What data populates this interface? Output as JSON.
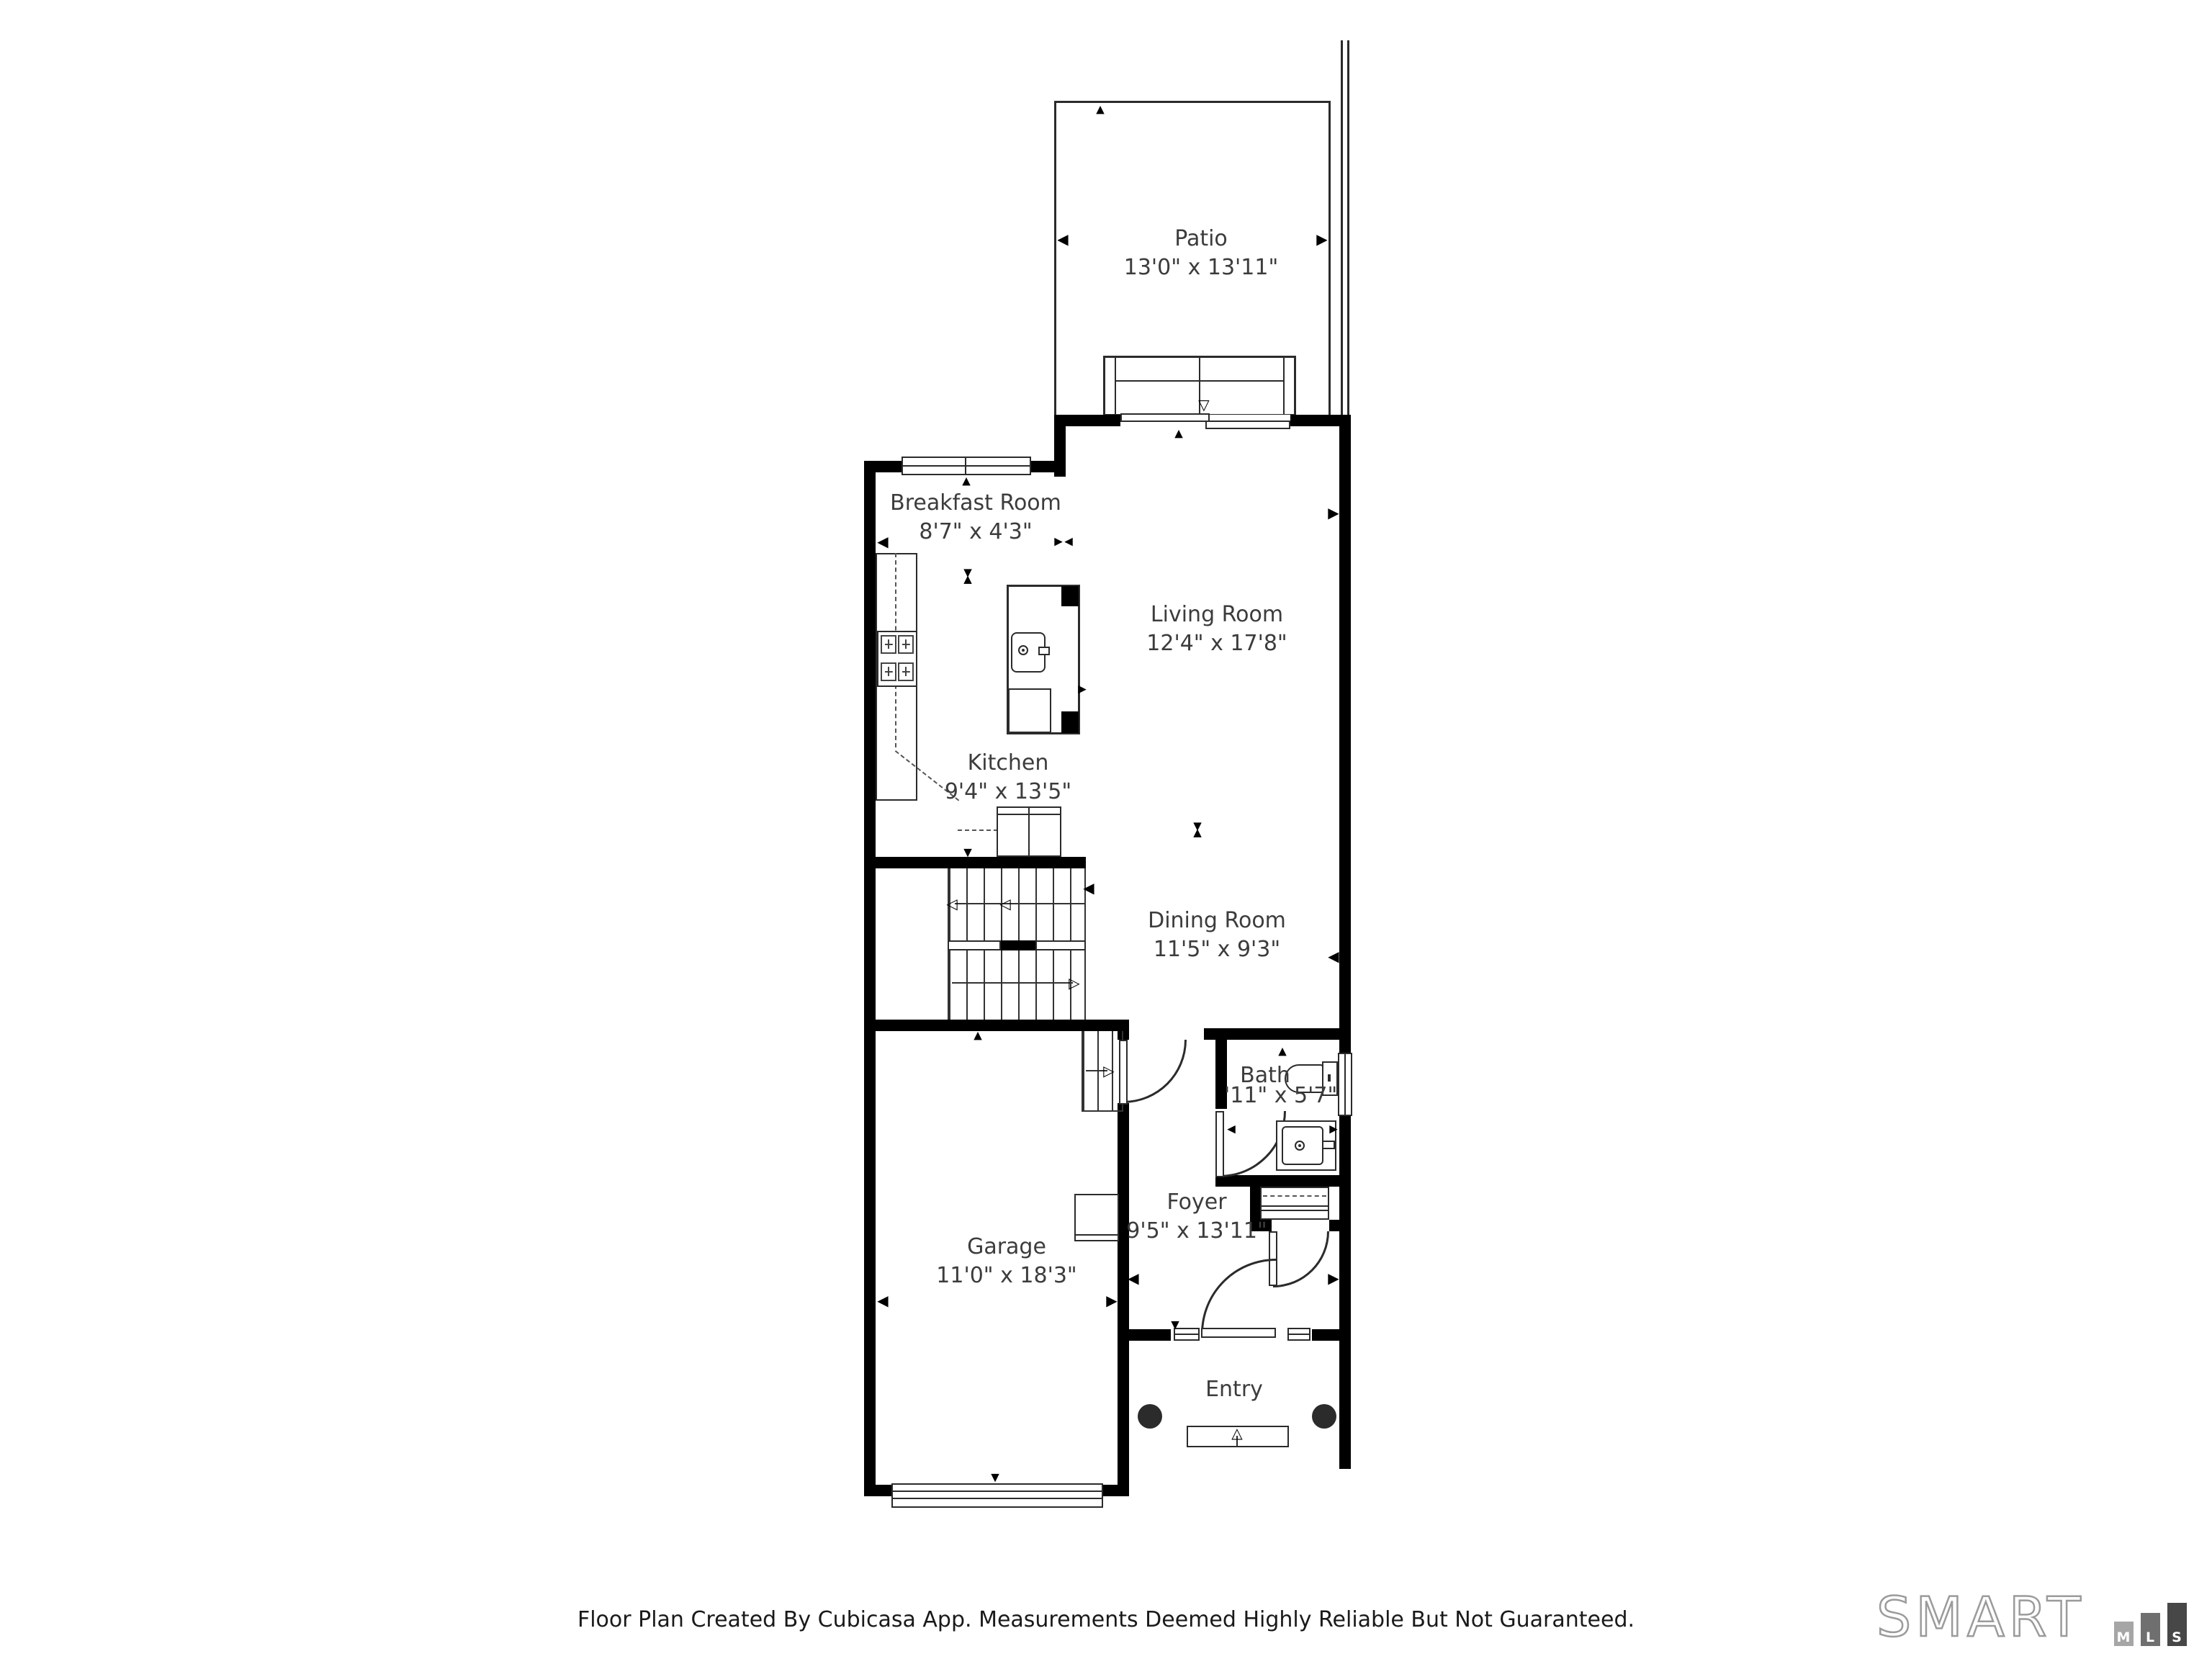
{
  "page": {
    "background": "#ffffff"
  },
  "rooms": {
    "patio": {
      "name": "Patio",
      "dims": "13'0\" x 13'11\""
    },
    "breakfast_room": {
      "name": "Breakfast Room",
      "dims": "8'7\" x 4'3\""
    },
    "living_room": {
      "name": "Living Room",
      "dims": "12'4\" x 17'8\""
    },
    "kitchen": {
      "name": "Kitchen",
      "dims": "9'4\" x 13'5\""
    },
    "dining_room": {
      "name": "Dining Room",
      "dims": "11'5\" x 9'3\""
    },
    "bath": {
      "name": "Bath",
      "dims": "'11\" x 5'7\""
    },
    "garage": {
      "name": "Garage",
      "dims": "11'0\" x 18'3\""
    },
    "foyer": {
      "name": "Foyer",
      "dims": "9'5\" x 13'11\""
    },
    "entry": {
      "name": "Entry"
    }
  },
  "footer": {
    "disclaimer": "Floor Plan Created By Cubicasa App. Measurements Deemed Highly Reliable But Not Guaranteed."
  },
  "logo": {
    "brand": "SMART",
    "blocks": [
      "M",
      "L",
      "S"
    ]
  },
  "icons": {
    "tri_up": "▲",
    "tri_down": "▼",
    "tri_left": "◀",
    "tri_right": "▶",
    "tri_up_open": "△",
    "tri_down_open": "▽",
    "tri_left_open": "◁",
    "tri_right_open": "▷"
  },
  "colors": {
    "wall": "#000000",
    "line": "#2b2b2b",
    "label": "#3c3c3c",
    "logo_outline": "#9b9b9b",
    "logo_m": "#a6a6a6",
    "logo_l": "#6f6f6f",
    "logo_s": "#474747"
  }
}
